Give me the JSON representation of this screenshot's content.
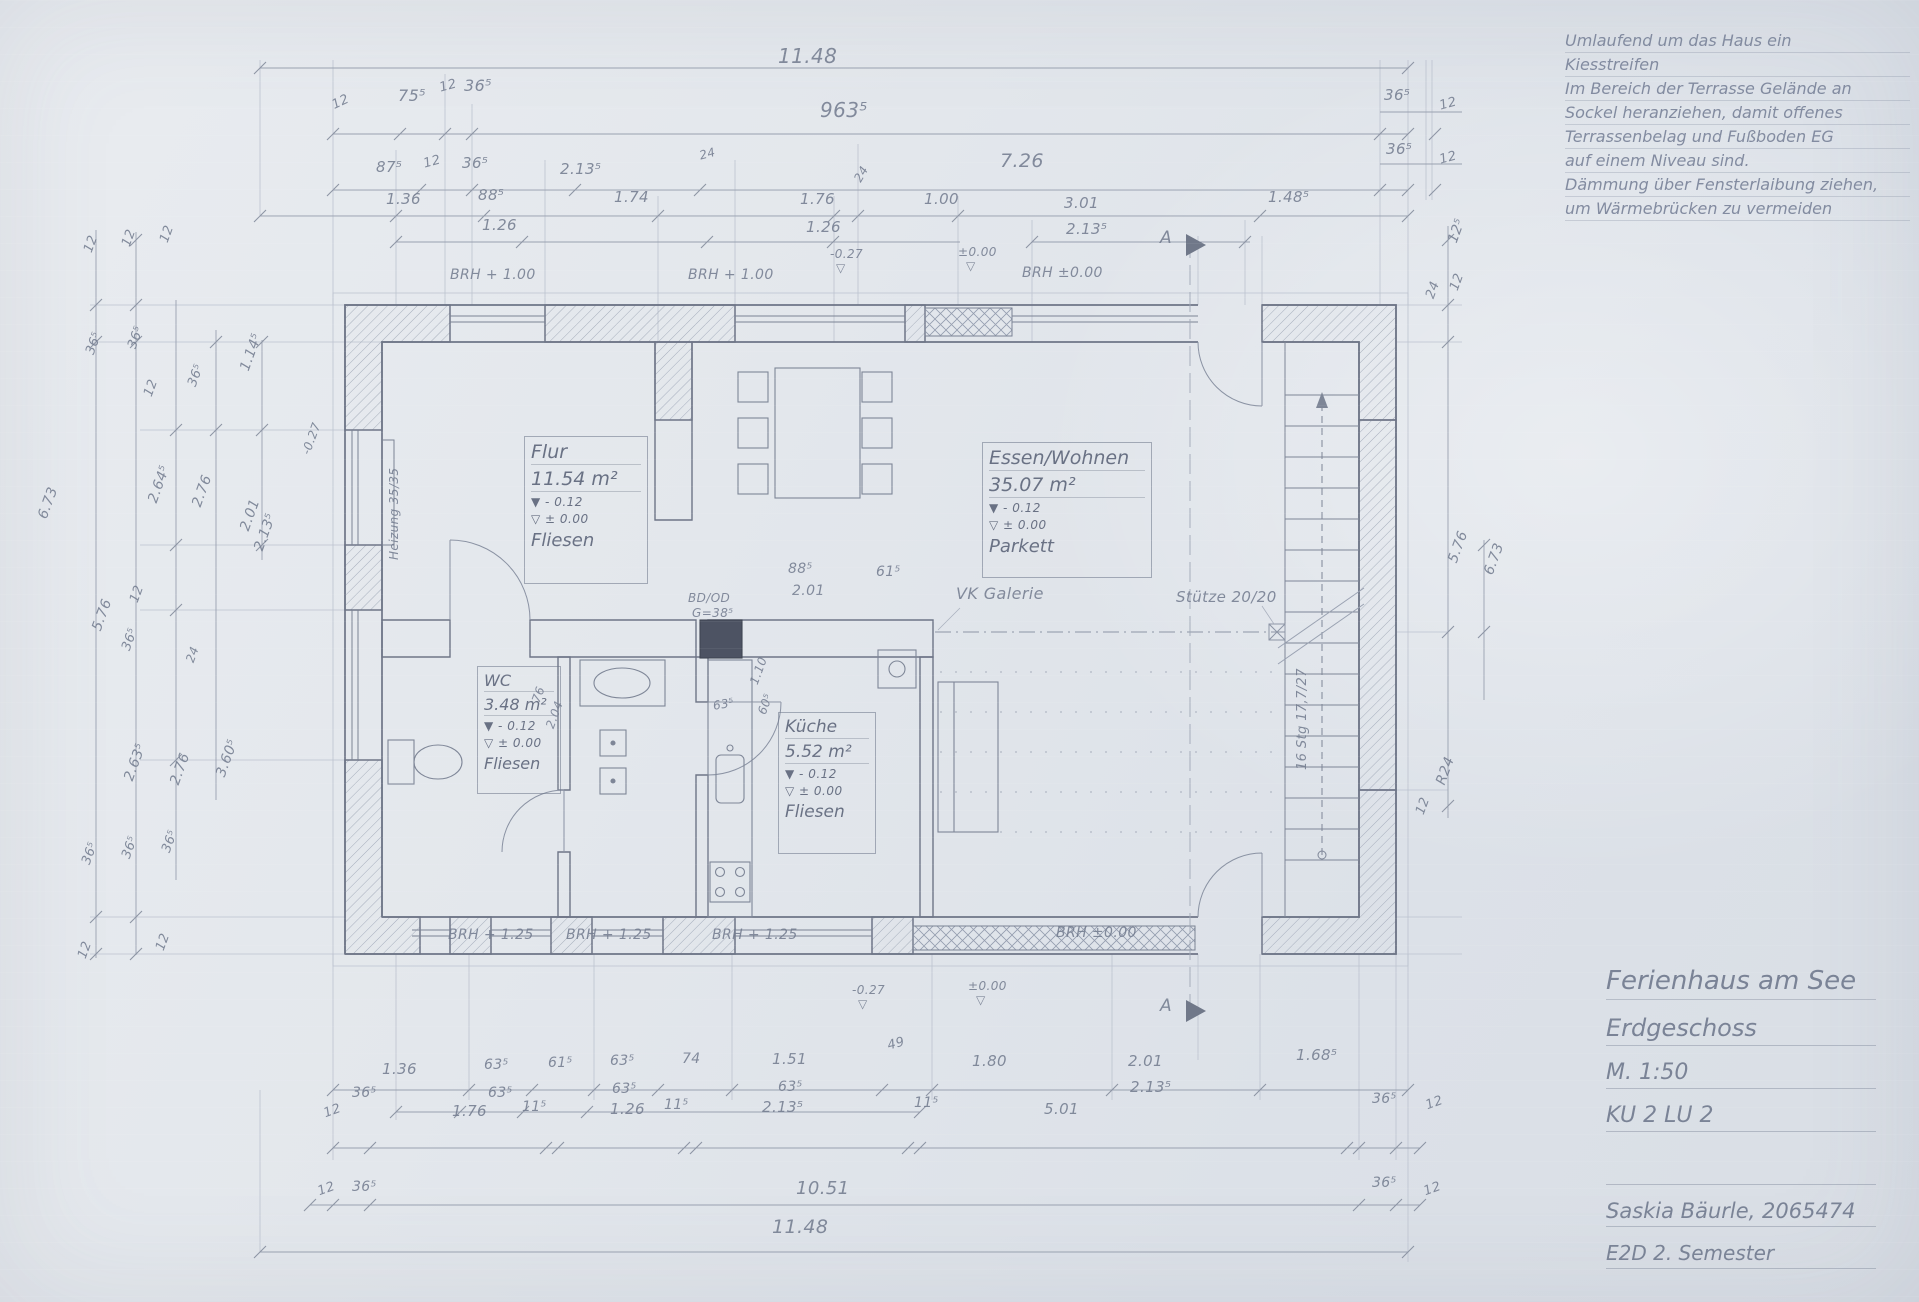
{
  "sheet": {
    "colors": {
      "paper": "#e2e6ec",
      "pencil": "#747d90",
      "wall": "#6e7587",
      "hatch": "#a3abba"
    },
    "notes": {
      "lines": [
        "Umlaufend um das Haus ein",
        "Kiesstreifen",
        "Im Bereich der Terrasse Gelände an",
        "Sockel heranziehen, damit offenes",
        "Terrassenbelag und Fußboden EG",
        "auf einem Niveau sind.",
        "Dämmung über Fensterlaibung ziehen,",
        "um Wärmebrücken zu vermeiden"
      ]
    },
    "title_block": {
      "lines": [
        "Ferienhaus am See",
        "Erdgeschoss",
        "M. 1:50",
        "KU 2 LU 2",
        "Saskia Bäurle, 2065474",
        "E2D 2. Semester"
      ]
    },
    "rooms": [
      {
        "name": "Flur",
        "area": "11.54 m²",
        "level_raw": "▼  - 0.12",
        "level_fin": "▽  ± 0.00",
        "finish": "Fliesen"
      },
      {
        "name": "Essen/Wohnen",
        "area": "35.07 m²",
        "level_raw": "▼  - 0.12",
        "level_fin": "▽  ± 0.00",
        "finish": "Parkett"
      },
      {
        "name": "WC",
        "area": "3.48 m²",
        "level_raw": "▼ - 0.12",
        "level_fin": "▽ ± 0.00",
        "finish": "Fliesen"
      },
      {
        "name": "Küche",
        "area": "5.52 m²",
        "level_raw": "▼ - 0.12",
        "level_fin": "▽ ± 0.00",
        "finish": "Fliesen"
      }
    ],
    "labels": [
      {
        "t": "11.48",
        "x": 778,
        "y": 46,
        "s": 20
      },
      {
        "t": "12",
        "x": 330,
        "y": 100,
        "r": -25,
        "s": 13
      },
      {
        "t": "75⁵",
        "x": 398,
        "y": 88,
        "s": 16
      },
      {
        "t": "12",
        "x": 438,
        "y": 82,
        "r": -15,
        "s": 13
      },
      {
        "t": "36⁵",
        "x": 464,
        "y": 78,
        "s": 16
      },
      {
        "t": "963⁵",
        "x": 820,
        "y": 100,
        "s": 20
      },
      {
        "t": "36⁵",
        "x": 1384,
        "y": 88,
        "s": 15
      },
      {
        "t": "12",
        "x": 1438,
        "y": 100,
        "r": -15,
        "s": 13
      },
      {
        "t": "87⁵",
        "x": 376,
        "y": 160,
        "s": 15
      },
      {
        "t": "12",
        "x": 422,
        "y": 158,
        "r": -15,
        "s": 13
      },
      {
        "t": "36⁵",
        "x": 462,
        "y": 156,
        "s": 15
      },
      {
        "t": "2.13⁵",
        "x": 560,
        "y": 162,
        "s": 15
      },
      {
        "t": "24",
        "x": 698,
        "y": 150,
        "r": -15,
        "s": 12
      },
      {
        "t": "7.26",
        "x": 1000,
        "y": 152,
        "s": 19
      },
      {
        "t": "36⁵",
        "x": 1386,
        "y": 142,
        "s": 15
      },
      {
        "t": "12",
        "x": 1438,
        "y": 154,
        "r": -15,
        "s": 13
      },
      {
        "t": "1.36",
        "x": 386,
        "y": 192,
        "s": 15
      },
      {
        "t": "88⁵",
        "x": 478,
        "y": 188,
        "s": 15
      },
      {
        "t": "1.26",
        "x": 482,
        "y": 218,
        "s": 15
      },
      {
        "t": "1.74",
        "x": 614,
        "y": 190,
        "s": 15
      },
      {
        "t": "1.76",
        "x": 800,
        "y": 192,
        "s": 15
      },
      {
        "t": "1.26",
        "x": 806,
        "y": 220,
        "s": 15
      },
      {
        "t": "24",
        "x": 852,
        "y": 178,
        "r": -60,
        "s": 12
      },
      {
        "t": "1.00",
        "x": 924,
        "y": 192,
        "s": 15
      },
      {
        "t": "3.01",
        "x": 1064,
        "y": 196,
        "s": 15
      },
      {
        "t": "2.13⁵",
        "x": 1066,
        "y": 222,
        "s": 15
      },
      {
        "t": "1.48⁵",
        "x": 1268,
        "y": 190,
        "s": 15
      },
      {
        "t": "BRH + 1.00",
        "x": 450,
        "y": 268,
        "s": 14
      },
      {
        "t": "BRH + 1.00",
        "x": 688,
        "y": 268,
        "s": 14
      },
      {
        "t": "-0.27",
        "x": 830,
        "y": 248,
        "s": 12
      },
      {
        "t": "▽",
        "x": 836,
        "y": 262,
        "s": 12
      },
      {
        "t": "±0.00",
        "x": 958,
        "y": 246,
        "s": 12
      },
      {
        "t": "▽",
        "x": 966,
        "y": 260,
        "s": 12
      },
      {
        "t": "BRH ±0.00",
        "x": 1022,
        "y": 266,
        "s": 14
      },
      {
        "t": "A",
        "x": 1160,
        "y": 230,
        "s": 17
      },
      {
        "t": "A",
        "x": 1160,
        "y": 998,
        "s": 17
      },
      {
        "t": "Heizung 35/35",
        "x": 388,
        "y": 560,
        "r": -90,
        "s": 12
      },
      {
        "t": "-0.27",
        "x": 300,
        "y": 452,
        "r": -70,
        "s": 12
      },
      {
        "t": "BD/OD",
        "x": 688,
        "y": 592,
        "s": 12
      },
      {
        "t": "G=38⁵",
        "x": 692,
        "y": 607,
        "s": 12
      },
      {
        "t": "88⁵",
        "x": 788,
        "y": 562,
        "s": 14
      },
      {
        "t": "2.01",
        "x": 792,
        "y": 584,
        "s": 14
      },
      {
        "t": "61⁵",
        "x": 876,
        "y": 565,
        "s": 14
      },
      {
        "t": "VK Galerie",
        "x": 956,
        "y": 586,
        "s": 16
      },
      {
        "t": "Stütze 20/20",
        "x": 1176,
        "y": 590,
        "s": 15
      },
      {
        "t": "16 Stg 17,7/27",
        "x": 1296,
        "y": 770,
        "r": -90,
        "s": 13
      },
      {
        "t": "63⁵",
        "x": 712,
        "y": 700,
        "r": -10,
        "s": 12
      },
      {
        "t": "1.10",
        "x": 748,
        "y": 682,
        "r": -70,
        "s": 12
      },
      {
        "t": "60⁵",
        "x": 756,
        "y": 712,
        "r": -70,
        "s": 12
      },
      {
        "t": "76",
        "x": 530,
        "y": 700,
        "r": -70,
        "s": 12
      },
      {
        "t": "2.04",
        "x": 544,
        "y": 726,
        "r": -70,
        "s": 12
      },
      {
        "t": "BRH + 1.25",
        "x": 448,
        "y": 928,
        "s": 14
      },
      {
        "t": "BRH + 1.25",
        "x": 566,
        "y": 928,
        "s": 14
      },
      {
        "t": "BRH + 1.25",
        "x": 712,
        "y": 928,
        "s": 14
      },
      {
        "t": "BRH ±0.00",
        "x": 1056,
        "y": 926,
        "s": 14
      },
      {
        "t": "-0.27",
        "x": 852,
        "y": 984,
        "s": 12
      },
      {
        "t": "▽",
        "x": 858,
        "y": 998,
        "s": 12
      },
      {
        "t": "±0.00",
        "x": 968,
        "y": 980,
        "s": 12
      },
      {
        "t": "▽",
        "x": 976,
        "y": 994,
        "s": 12
      },
      {
        "t": "1.36",
        "x": 382,
        "y": 1062,
        "s": 15
      },
      {
        "t": "36⁵",
        "x": 352,
        "y": 1086,
        "s": 14
      },
      {
        "t": "63⁵",
        "x": 484,
        "y": 1058,
        "s": 14
      },
      {
        "t": "63⁵",
        "x": 488,
        "y": 1086,
        "s": 14
      },
      {
        "t": "61⁵",
        "x": 548,
        "y": 1056,
        "s": 14
      },
      {
        "t": "63⁵",
        "x": 610,
        "y": 1054,
        "s": 14
      },
      {
        "t": "63⁵",
        "x": 612,
        "y": 1082,
        "s": 14
      },
      {
        "t": "74",
        "x": 682,
        "y": 1052,
        "s": 14
      },
      {
        "t": "1.51",
        "x": 772,
        "y": 1052,
        "s": 15
      },
      {
        "t": "63⁵",
        "x": 778,
        "y": 1080,
        "s": 14
      },
      {
        "t": "49",
        "x": 886,
        "y": 1040,
        "r": -15,
        "s": 13
      },
      {
        "t": "1.80",
        "x": 972,
        "y": 1054,
        "s": 15
      },
      {
        "t": "2.01",
        "x": 1128,
        "y": 1054,
        "s": 15
      },
      {
        "t": "2.13⁵",
        "x": 1130,
        "y": 1080,
        "s": 15
      },
      {
        "t": "1.68⁵",
        "x": 1296,
        "y": 1048,
        "s": 15
      },
      {
        "t": "12",
        "x": 322,
        "y": 1108,
        "r": -20,
        "s": 13
      },
      {
        "t": "1.76",
        "x": 452,
        "y": 1104,
        "s": 15
      },
      {
        "t": "11⁵",
        "x": 522,
        "y": 1100,
        "s": 14
      },
      {
        "t": "1.26",
        "x": 610,
        "y": 1102,
        "s": 15
      },
      {
        "t": "11⁵",
        "x": 664,
        "y": 1098,
        "s": 14
      },
      {
        "t": "2.13⁵",
        "x": 762,
        "y": 1100,
        "s": 15
      },
      {
        "t": "11⁵",
        "x": 914,
        "y": 1096,
        "s": 14
      },
      {
        "t": "5.01",
        "x": 1044,
        "y": 1102,
        "s": 15
      },
      {
        "t": "36⁵",
        "x": 1372,
        "y": 1092,
        "s": 14
      },
      {
        "t": "12",
        "x": 1424,
        "y": 1100,
        "r": -20,
        "s": 13
      },
      {
        "t": "12",
        "x": 316,
        "y": 1186,
        "r": -20,
        "s": 13
      },
      {
        "t": "36⁵",
        "x": 352,
        "y": 1180,
        "s": 14
      },
      {
        "t": "10.51",
        "x": 796,
        "y": 1180,
        "s": 18
      },
      {
        "t": "36⁵",
        "x": 1372,
        "y": 1176,
        "s": 14
      },
      {
        "t": "12",
        "x": 1422,
        "y": 1186,
        "r": -20,
        "s": 13
      },
      {
        "t": "11.48",
        "x": 772,
        "y": 1218,
        "s": 19
      },
      {
        "t": "12",
        "x": 82,
        "y": 250,
        "r": -70,
        "s": 13
      },
      {
        "t": "12",
        "x": 120,
        "y": 244,
        "r": -70,
        "s": 13
      },
      {
        "t": "12",
        "x": 158,
        "y": 240,
        "r": -70,
        "s": 13
      },
      {
        "t": "36⁵",
        "x": 84,
        "y": 352,
        "r": -70,
        "s": 13
      },
      {
        "t": "36⁵",
        "x": 126,
        "y": 346,
        "r": -70,
        "s": 13
      },
      {
        "t": "12",
        "x": 142,
        "y": 394,
        "r": -70,
        "s": 13
      },
      {
        "t": "36⁵",
        "x": 186,
        "y": 384,
        "r": -70,
        "s": 13
      },
      {
        "t": "1.14⁵",
        "x": 238,
        "y": 368,
        "r": -70,
        "s": 14
      },
      {
        "t": "2.64⁵",
        "x": 146,
        "y": 500,
        "r": -70,
        "s": 14
      },
      {
        "t": "2.76",
        "x": 190,
        "y": 504,
        "r": -70,
        "s": 14
      },
      {
        "t": "2.01",
        "x": 238,
        "y": 528,
        "r": -70,
        "s": 14
      },
      {
        "t": "2.13⁵",
        "x": 252,
        "y": 548,
        "r": -70,
        "s": 14
      },
      {
        "t": "6.73",
        "x": 36,
        "y": 516,
        "r": -70,
        "s": 14
      },
      {
        "t": "5.76",
        "x": 90,
        "y": 628,
        "r": -70,
        "s": 14
      },
      {
        "t": "12",
        "x": 128,
        "y": 600,
        "r": -70,
        "s": 13
      },
      {
        "t": "36⁵",
        "x": 120,
        "y": 648,
        "r": -70,
        "s": 13
      },
      {
        "t": "24",
        "x": 184,
        "y": 660,
        "r": -70,
        "s": 12
      },
      {
        "t": "2.63⁵",
        "x": 122,
        "y": 778,
        "r": -70,
        "s": 14
      },
      {
        "t": "2.76",
        "x": 168,
        "y": 782,
        "r": -70,
        "s": 14
      },
      {
        "t": "3.60⁵",
        "x": 214,
        "y": 774,
        "r": -70,
        "s": 14
      },
      {
        "t": "36⁵",
        "x": 80,
        "y": 862,
        "r": -70,
        "s": 13
      },
      {
        "t": "36⁵",
        "x": 120,
        "y": 856,
        "r": -70,
        "s": 13
      },
      {
        "t": "36⁵",
        "x": 160,
        "y": 850,
        "r": -70,
        "s": 13
      },
      {
        "t": "12",
        "x": 76,
        "y": 956,
        "r": -70,
        "s": 13
      },
      {
        "t": "12",
        "x": 154,
        "y": 948,
        "r": -70,
        "s": 13
      },
      {
        "t": "12⁵",
        "x": 1446,
        "y": 240,
        "r": -70,
        "s": 14
      },
      {
        "t": "24",
        "x": 1424,
        "y": 296,
        "r": -70,
        "s": 13
      },
      {
        "t": "12",
        "x": 1448,
        "y": 288,
        "r": -70,
        "s": 13
      },
      {
        "t": "5.76",
        "x": 1446,
        "y": 560,
        "r": -70,
        "s": 14
      },
      {
        "t": "6.73",
        "x": 1482,
        "y": 572,
        "r": -70,
        "s": 14
      },
      {
        "t": "R24",
        "x": 1434,
        "y": 782,
        "r": -70,
        "s": 14
      },
      {
        "t": "12",
        "x": 1414,
        "y": 812,
        "r": -70,
        "s": 13
      }
    ]
  }
}
